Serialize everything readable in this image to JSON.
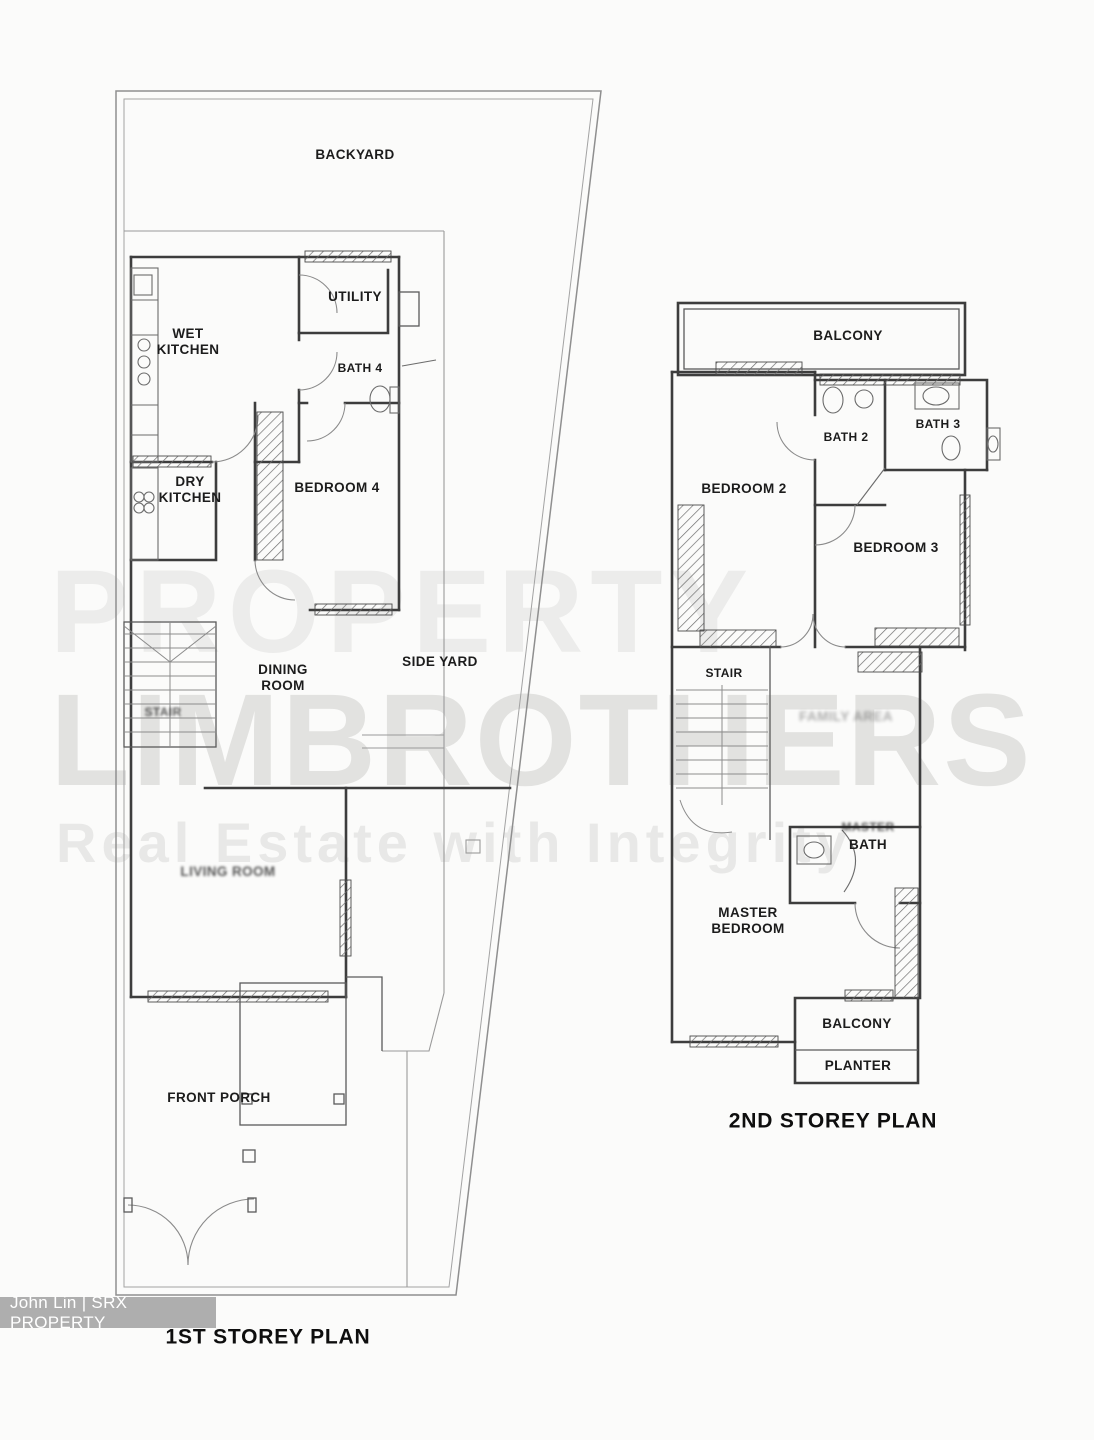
{
  "watermark": {
    "line1": "PROPERTY",
    "line2": "LIMBROTHERS",
    "line3": "Real Estate with Integrity"
  },
  "credit": {
    "text": "John Lin | SRX PROPERTY"
  },
  "first_storey": {
    "title": "1ST STOREY PLAN",
    "rooms": {
      "backyard": "BACKYARD",
      "wet_kitchen": "WET\nKITCHEN",
      "utility": "UTILITY",
      "bath4": "BATH 4",
      "dry_kitchen": "DRY\nKITCHEN",
      "bedroom4": "BEDROOM 4",
      "dining_room": "DINING\nROOM",
      "side_yard": "SIDE YARD",
      "stair": "STAIR",
      "living_room": "LIVING ROOM",
      "front_porch": "FRONT PORCH"
    }
  },
  "second_storey": {
    "title": "2ND STOREY PLAN",
    "rooms": {
      "balcony_top": "BALCONY",
      "bath2": "BATH 2",
      "bath3": "BATH 3",
      "bedroom2": "BEDROOM 2",
      "bedroom3": "BEDROOM 3",
      "stair": "STAIR",
      "family_area": "FAMILY AREA",
      "master_bath_word1": "MASTER",
      "master_bath_word2": "BATH",
      "master_bedroom": "MASTER\nBEDROOM",
      "balcony_bottom": "BALCONY",
      "planter": "PLANTER"
    }
  },
  "colors": {
    "wall": "#3d3d3d",
    "lot_boundary": "#8f8f8f",
    "label": "#1c1c1c",
    "watermark": "#e6e6e3",
    "credit_bg": "#aeaeae",
    "credit_text": "#ffffff",
    "background": "#fbfbfa"
  }
}
